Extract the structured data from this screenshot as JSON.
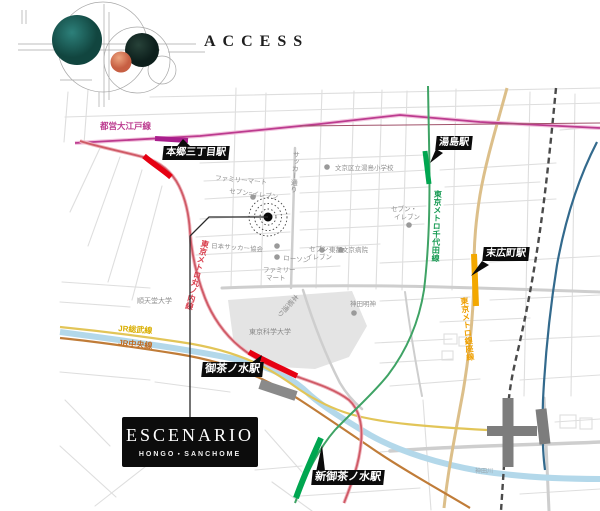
{
  "brand": {
    "title": "ACCESS"
  },
  "property": {
    "name": "ESCENARIO",
    "subtitle": "HONGO・SANCHOME"
  },
  "map": {
    "stations": {
      "hongo_sanchome": "本郷三丁目駅",
      "yushima": "湯島駅",
      "suehirocho": "末広町駅",
      "ochanomizu": "御茶ノ水駅",
      "shin_ochanomizu": "新御茶ノ水駅"
    },
    "lines": {
      "oedo": {
        "label": "都営大江戸線",
        "color": "#bc3b8f"
      },
      "marunouchi": {
        "label": "東京メトロ丸ノ内線",
        "color": "#e60012"
      },
      "chiyoda": {
        "label": "東京メトロ千代田線",
        "color": "#00a650"
      },
      "ginza": {
        "label": "東京メトロ銀座線",
        "color": "#f0a000"
      },
      "jr_sobu": {
        "label": "JR総武線",
        "color": "#d9ae00"
      },
      "jr_chuo": {
        "label": "JR中央線",
        "color": "#c06a20"
      }
    },
    "pois": {
      "familymart_north": "ファミリーマート",
      "seven_eleven_north": "セブン=イレブン",
      "yushima_elementary": "文京区立湯島小学校",
      "soccer_street": "サッカー通り",
      "football_association": "日本サッカー協会",
      "lawson": "ローソン",
      "seven_eleven_yushima_l1": "セブン・",
      "seven_eleven_yushima_l2": "イレブン",
      "seven_eleven_hospital_l1": "セブン-",
      "seven_eleven_hospital_l2": "イレブン",
      "familymart_south_l1": "ファミリー",
      "familymart_south_l2": "マート",
      "juntendo_university": "順天堂大学",
      "tohto_bunkyo_hospital": "東都文京病院",
      "kanda_myojin": "神田明神",
      "hongo_street": "本郷通り",
      "science_tokyo_university": "東京科学大学",
      "kanda_river": "神田川"
    }
  }
}
